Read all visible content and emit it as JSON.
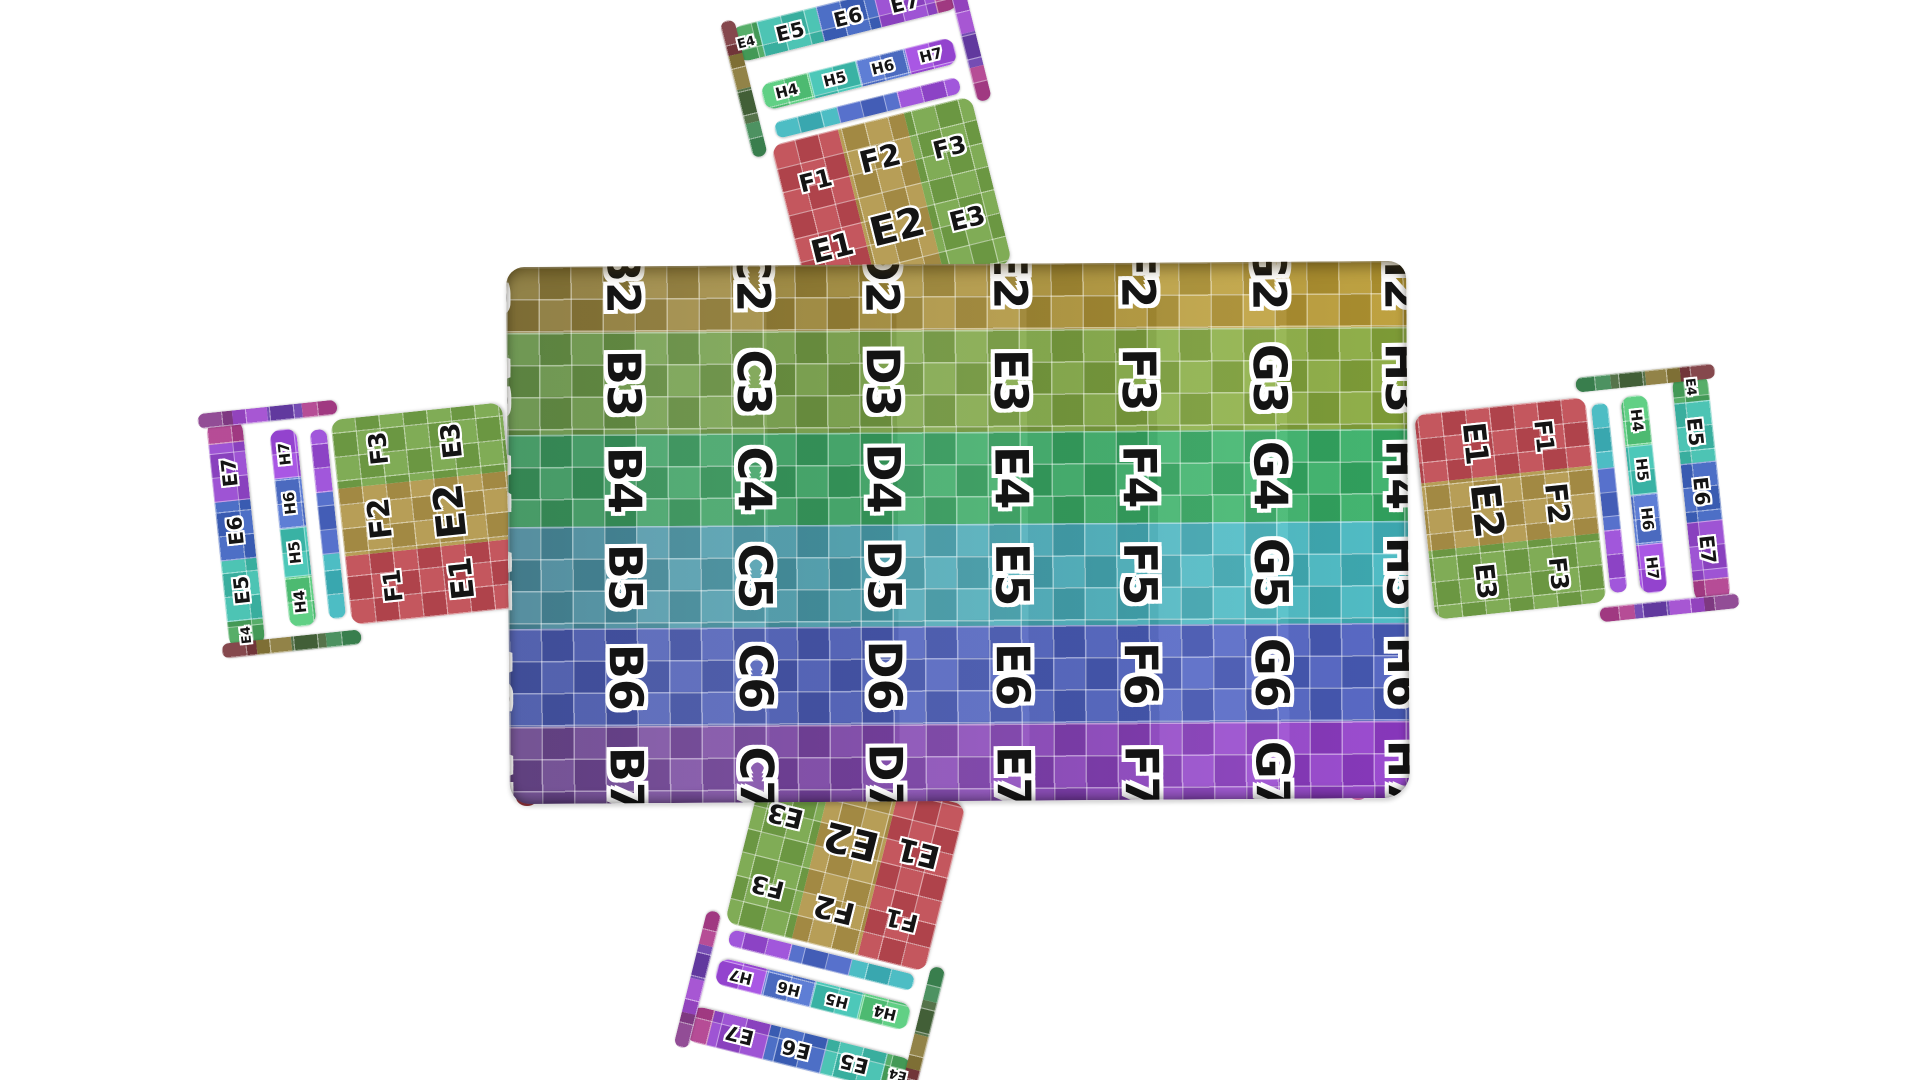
{
  "scene": {
    "background": "#ffffff"
  },
  "table": {
    "columns": [
      "A",
      "B",
      "C",
      "D",
      "E",
      "F",
      "G",
      "H"
    ],
    "grid_line_color": "#ffffff",
    "rows": [
      {
        "number": "2",
        "color_left": "#8f7d3d",
        "color_right": "#c4a335",
        "labels": [
          "A2",
          "B2",
          "C2",
          "D2",
          "E2",
          "F2",
          "G2",
          "H2"
        ]
      },
      {
        "number": "3",
        "color_left": "#69974b",
        "color_right": "#90b23e",
        "labels": [
          "A3",
          "B3",
          "C3",
          "D3",
          "E3",
          "F3",
          "G3",
          "H3"
        ]
      },
      {
        "number": "4",
        "color_left": "#3d9a60",
        "color_right": "#38b86a",
        "labels": [
          "A4",
          "B4",
          "C4",
          "D4",
          "E4",
          "F4",
          "G4",
          "H4"
        ]
      },
      {
        "number": "5",
        "color_left": "#4e8da0",
        "color_right": "#46c2ca",
        "labels": [
          "A5",
          "B5",
          "C5",
          "D5",
          "E5",
          "F5",
          "G5",
          "H5"
        ]
      },
      {
        "number": "6",
        "color_left": "#4a5ab0",
        "color_right": "#4f63c8",
        "labels": [
          "A6",
          "B6",
          "C6",
          "D6",
          "E6",
          "F6",
          "G6",
          "H6"
        ]
      },
      {
        "number": "7",
        "color_left": "#6f4b92",
        "color_right": "#9c40d8",
        "labels": [
          "A7",
          "B7",
          "C7",
          "D7",
          "E7",
          "F7",
          "G7",
          "H7"
        ]
      }
    ],
    "legs": [
      {
        "name": "left-leg",
        "color": "#8b3038"
      },
      {
        "name": "right-leg",
        "color": "#d873b2"
      }
    ]
  },
  "chair": {
    "seat": {
      "columns": [
        {
          "color": "#c04a52",
          "labels": [
            "F1",
            "E1"
          ]
        },
        {
          "color": "#b2974a",
          "labels": [
            "F2",
            "E2"
          ]
        },
        {
          "color": "#76a649",
          "labels": [
            "F3",
            "E3"
          ]
        }
      ]
    },
    "top_rail": [
      {
        "label": "E4",
        "color": "#4aa85e",
        "w": 13
      },
      {
        "label": "E5",
        "color": "#3fbfae",
        "w": 26
      },
      {
        "label": "E6",
        "color": "#3f64c2",
        "w": 25
      },
      {
        "label": "E7",
        "color": "#9747d1",
        "w": 25
      },
      {
        "label": "",
        "color": "#b03f8e",
        "w": 11
      }
    ],
    "mid_slat": [
      {
        "label": "H4",
        "color": "#55cc7c",
        "w": 25
      },
      {
        "label": "H5",
        "color": "#3fc4b4",
        "w": 25
      },
      {
        "label": "H6",
        "color": "#5274d2",
        "w": 25
      },
      {
        "label": "H7",
        "color": "#a24ae2",
        "w": 25
      }
    ],
    "bottom_rail": [
      {
        "label": "",
        "color": "#3fb8c0",
        "w": 34
      },
      {
        "label": "",
        "color": "#4a66c8",
        "w": 33
      },
      {
        "label": "",
        "color": "#9a4ad8",
        "w": 33
      }
    ],
    "left_post_colors": [
      "#7c3a3f",
      "#8a7a3a",
      "#49683c",
      "#3f8a55"
    ],
    "right_post_colors": [
      "#8a3f8e",
      "#a04ad0",
      "#6b3fae",
      "#b03f8e"
    ],
    "instances": [
      {
        "name": "chair-top"
      },
      {
        "name": "chair-right"
      },
      {
        "name": "chair-bottom"
      },
      {
        "name": "chair-left"
      }
    ]
  }
}
